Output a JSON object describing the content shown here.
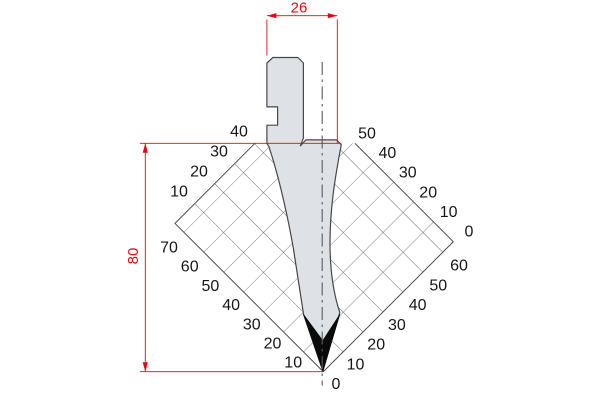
{
  "dimensions": {
    "width_label": "26",
    "height_label": "80"
  },
  "grid_scales": {
    "upper_left": [
      "40",
      "30",
      "20",
      "10"
    ],
    "lower_left": [
      "70",
      "60",
      "50",
      "40",
      "30",
      "20",
      "10"
    ],
    "upper_right": [
      "50",
      "40",
      "30",
      "20",
      "10",
      "0"
    ],
    "lower_right": [
      "60",
      "50",
      "40",
      "30",
      "20",
      "10"
    ],
    "origin": "0"
  },
  "colors": {
    "dimension_red": "#e30613",
    "tool_fill": "#dee2e7",
    "tool_outline": "#474747",
    "grid_line": "#3d3d3d",
    "tip_black": "#0a0a0a",
    "label_black": "#161616"
  }
}
